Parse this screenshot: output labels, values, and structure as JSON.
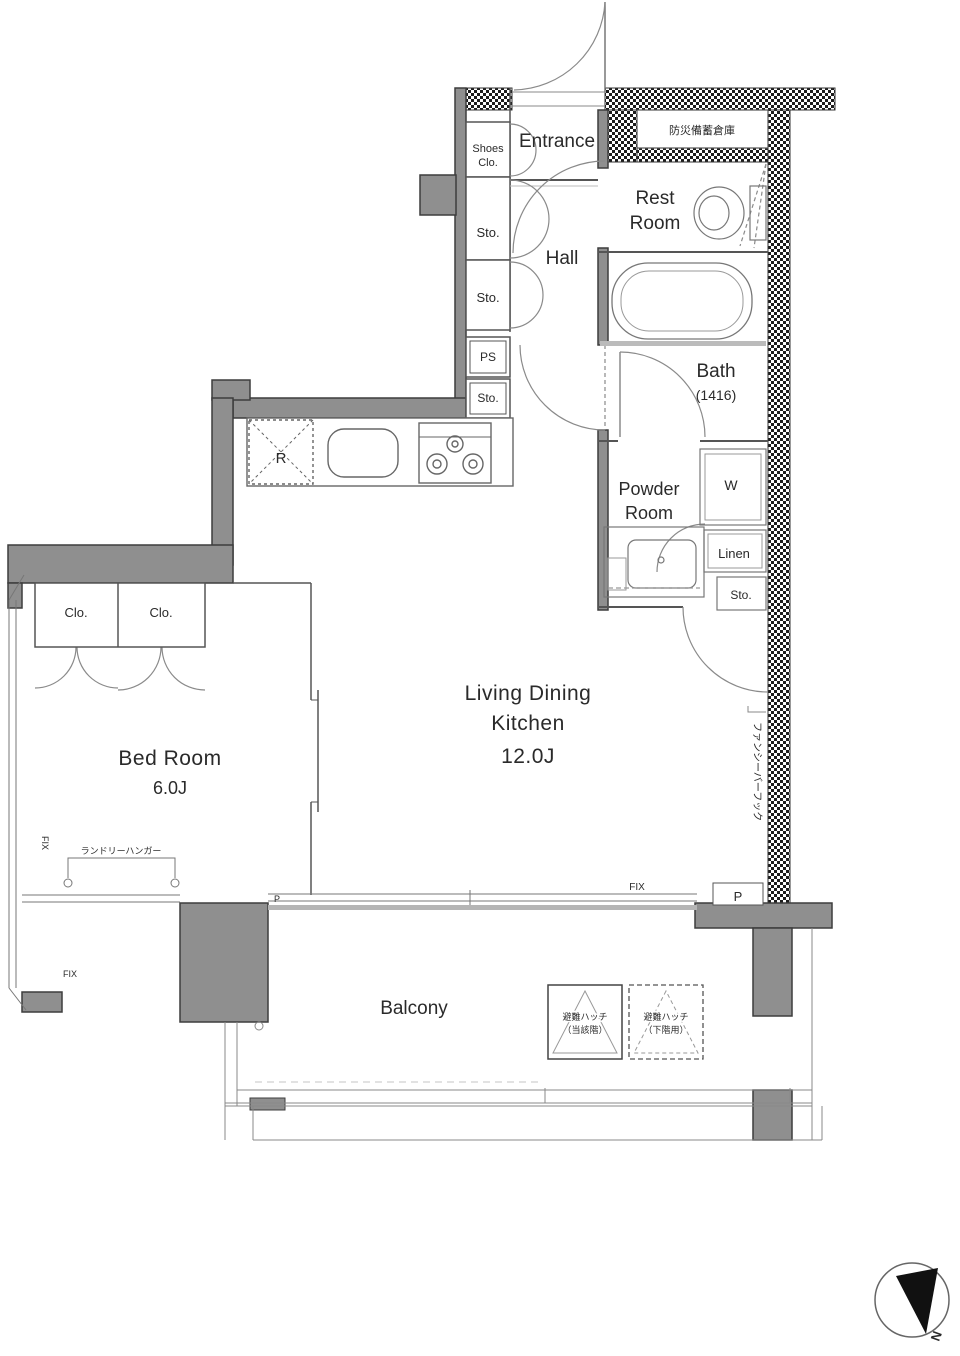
{
  "plan": {
    "rooms": {
      "entrance": "Entrance",
      "hall": "Hall",
      "rest_room_1": "Rest",
      "rest_room_2": "Room",
      "disaster_storage": "防災備蓄倉庫",
      "bath_1": "Bath",
      "bath_2": "(1416)",
      "powder_1": "Powder",
      "powder_2": "Room",
      "ldk_1": "Living Dining",
      "ldk_2": "Kitchen",
      "ldk_3": "12.0J",
      "bedroom_1": "Bed Room",
      "bedroom_2": "6.0J",
      "balcony": "Balcony"
    },
    "storage": {
      "shoes_1": "Shoes",
      "shoes_2": "Clo.",
      "sto_hall_upper": "Sto.",
      "sto_hall_lower": "Sto.",
      "ps": "PS",
      "sto_kitchen": "Sto.",
      "closet_left": "Clo.",
      "closet_right": "Clo.",
      "linen": "Linen",
      "sto_powder": "Sto.",
      "washer": "W",
      "refrigerator": "R"
    },
    "annotations": {
      "laundry_hanger": "ランドリーハンガー",
      "fancy_bar_hook": "ファンシーバーフック",
      "hatch_solid_1": "避難ハッチ",
      "hatch_solid_2": "（当該階）",
      "hatch_dashed_1": "避難ハッチ",
      "hatch_dashed_2": "（下階用）",
      "fix_side": "FIX",
      "fix_corner": "FIX",
      "fix_ldk": "FIX",
      "p_partition": "P",
      "p_pipe": "P",
      "north": "N"
    },
    "colors": {
      "wall_gray": "#8f8f8f",
      "line": "#555555",
      "hatch_dark": "#1c1c1c"
    }
  }
}
